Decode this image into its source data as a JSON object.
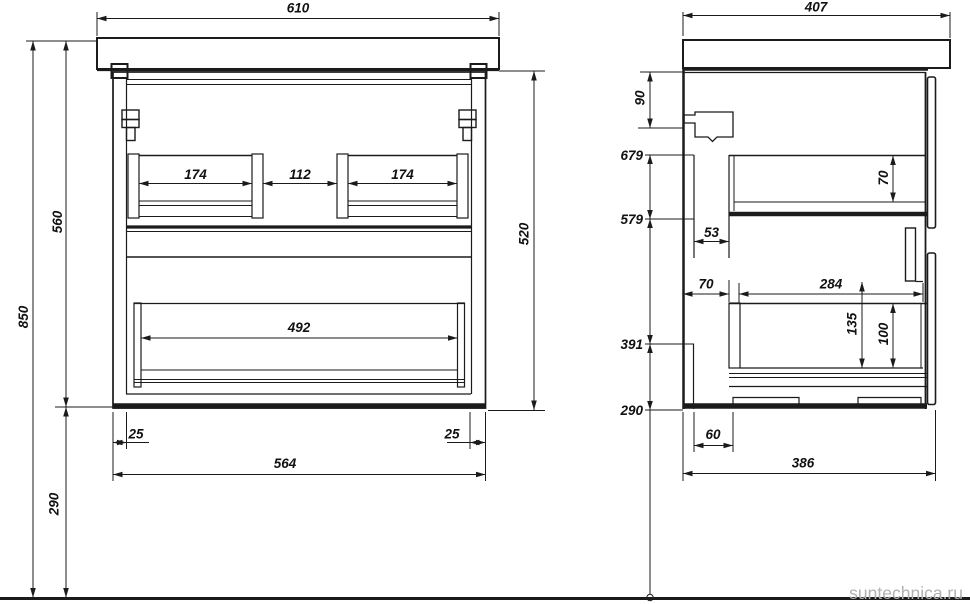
{
  "front": {
    "overall_width": "610",
    "cutout_left": "174",
    "cutout_gap": "112",
    "cutout_right": "174",
    "cabinet_height": "560",
    "overall_height": "850",
    "carcass_height": "520",
    "drawer_width": "492",
    "base_inset_left": "25",
    "base_inset_right": "25",
    "base_width": "564",
    "underneath_clearance": "290"
  },
  "side": {
    "overall_depth": "407",
    "hanger_drop": "90",
    "level_1": "679",
    "level_2": "579",
    "level_3": "391",
    "level_4": "290",
    "upper_drawer_height": "70",
    "hanger_gap": "53",
    "rear_clearance": "70",
    "drawer_depth": "284",
    "drawer_back_height": "135",
    "drawer_side_height": "100",
    "base_inset": "60",
    "base_depth": "386"
  },
  "watermark": "suntechnica.ru",
  "colors": {
    "line": "#1b1b1b",
    "watermark": "#b1b1b1",
    "background": "#ffffff"
  }
}
